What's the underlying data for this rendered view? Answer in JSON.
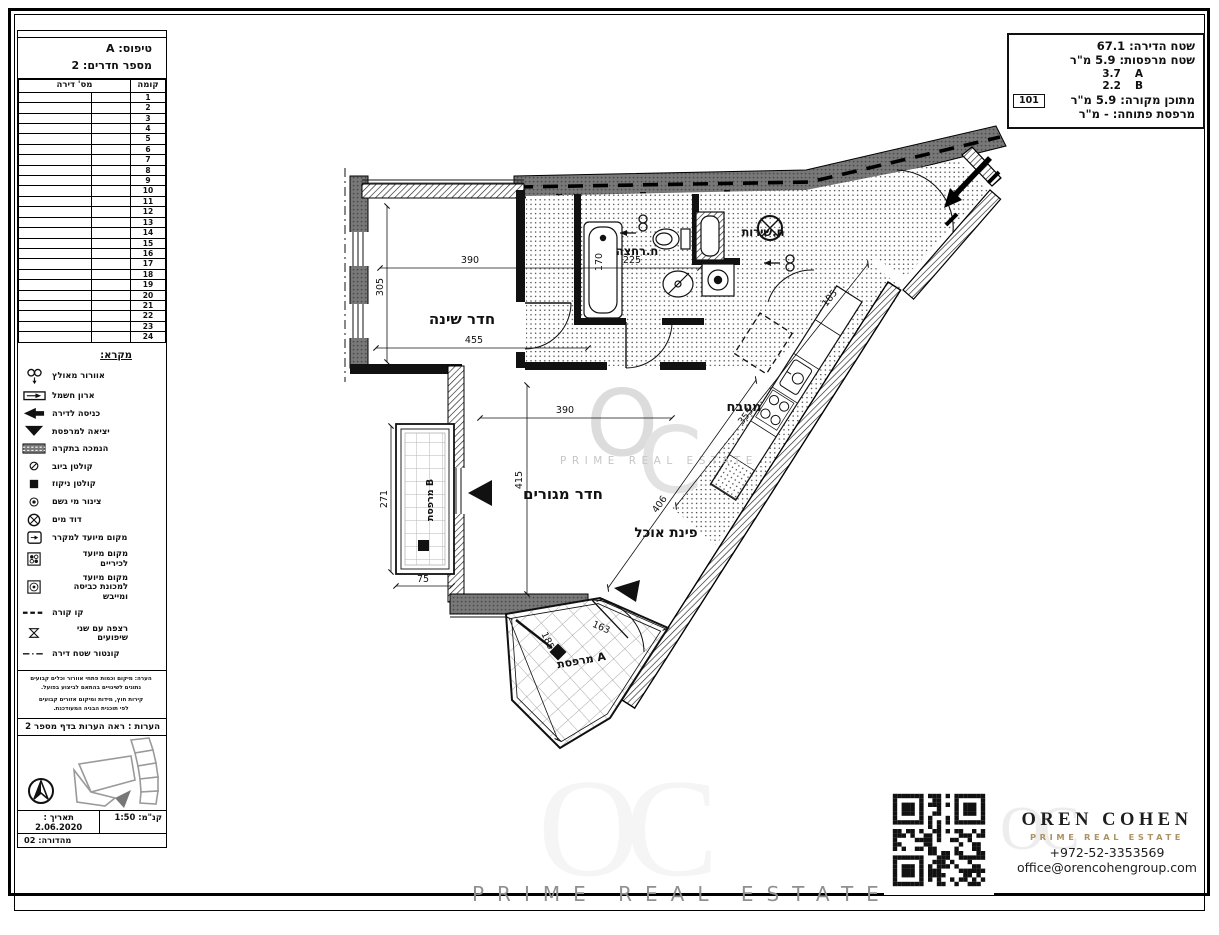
{
  "sidebar": {
    "type_label": "טיפוס: A",
    "rooms_label": "מספר חדרים: 2",
    "table": {
      "col_floor": "קומה",
      "col_apartment": "מס' דירה",
      "floors": [
        "1",
        "2",
        "3",
        "4",
        "5",
        "6",
        "7",
        "8",
        "9",
        "10",
        "11",
        "12",
        "13",
        "14",
        "15",
        "16",
        "17",
        "18",
        "19",
        "20",
        "21",
        "22",
        "23",
        "24"
      ]
    },
    "legend_title": "מקרא:",
    "legend": {
      "items": [
        {
          "label": "אוורור מאולץ",
          "icon": "forced-vent"
        },
        {
          "label": "ארון חשמל",
          "icon": "electric-cabinet"
        },
        {
          "label": "כניסה לדירה",
          "icon": "entry-arrow"
        },
        {
          "label": "יציאה למרפסת",
          "icon": "balcony-exit"
        },
        {
          "label": "הנמכה בתקרה",
          "icon": "ceiling-drop"
        },
        {
          "label": "קולטן ביוב",
          "icon": "sewage-drain"
        },
        {
          "label": "קולטן ניקוז",
          "icon": "drainage"
        },
        {
          "label": "צינור מי גשם",
          "icon": "rain-pipe"
        },
        {
          "label": "דוד מים",
          "icon": "water-heater"
        },
        {
          "label": "מקום מיועד למקרר",
          "icon": "fridge"
        },
        {
          "label": "מקום מיועד לכיריים",
          "icon": "stove"
        },
        {
          "label": "מקום מיועד למכונת כביסה ומייבש",
          "icon": "washer"
        },
        {
          "label": "קו קורה",
          "icon": "beam-line"
        },
        {
          "label": "רצפה עם שני שיפועים",
          "icon": "slope-floor"
        },
        {
          "label": "קונטור שטח דירה",
          "icon": "contour-line"
        }
      ]
    },
    "notes_small": [
      "הערה: מיקום וכמות פתחי אוורור וכלים קבועים",
      "נתונים לשינויים בהתאם לביצוע בפועל.",
      "קירות חוץ, מידות ומיקום אזורים קבועים",
      "לפי תוכנית הבניה המעודכנת."
    ],
    "notes_ref": "הערות : ראה הערות בדף מספר 2",
    "scale_label": "קנ\"מ: 1:50",
    "date_label": "תאריך : 2.06.2020",
    "revision": "מהדורה: 02"
  },
  "area_box": {
    "apartment_area": "שטח הדירה: 67.1",
    "balconies_area": "שטח מרפסות: 5.9 מ\"ר",
    "balcony_a_value": "3.7",
    "balcony_a_letter": "A",
    "balcony_b_value": "2.2",
    "balcony_b_letter": "B",
    "covered": "מתוכן מקורה: 5.9 מ\"ר",
    "unit_number": "101",
    "open_balcony": "מרפסת פתוחה: - מ\"ר"
  },
  "plan": {
    "rooms": {
      "bedroom": "חדר שינה",
      "bath": "ח.רחצה",
      "wc": "ח.שירות",
      "kitchen": "מטבח",
      "living": "חדר מגורים",
      "dining": "פינת אוכל",
      "balcony_a": "מרפסת A",
      "balcony_b": "מרפסת B"
    },
    "dims": {
      "bedroom_w": "390",
      "bedroom_h": "305",
      "bedroom_w2": "455",
      "bath_w": "225",
      "tub_h": "170",
      "living_w": "390",
      "living_h": "415",
      "dining_d": "406",
      "corridor_d1": "185",
      "corridor_d2": "355",
      "balcony_b_h": "271",
      "balcony_b_w": "75",
      "balcony_a_w": "163",
      "balcony_a_h": "185"
    }
  },
  "watermark": {
    "letter_o": "O",
    "letter_c": "C",
    "oc": "OC",
    "text": "PRIME REAL ESTATE"
  },
  "brand": {
    "name": "OREN COHEN",
    "tagline": "PRIME REAL ESTATE",
    "phone": "+972-52-3353569",
    "email": "office@orencohengroup.com",
    "gold": "#ad9364"
  }
}
